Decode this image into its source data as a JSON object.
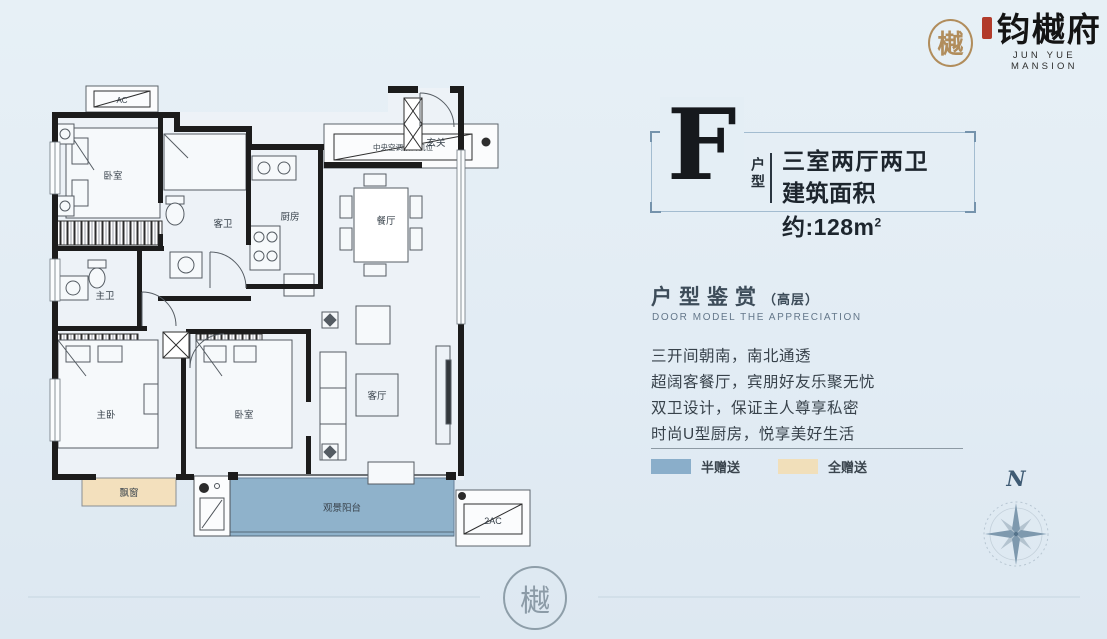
{
  "page": {
    "background": "#e4eef5"
  },
  "logo": {
    "seal_char": "樾",
    "brand_cn": "钧樾府",
    "brand_en": "JUN YUE MANSION"
  },
  "unit": {
    "letter": "F",
    "type_vertical": "户型",
    "spec": "三室两厅两卫",
    "area_prefix": "建筑面积约:",
    "area_value": "128m",
    "area_exponent": "2"
  },
  "section": {
    "title": "户型鉴赏",
    "title_note": "（高层）",
    "subtitle": "DOOR MODEL THE APPRECIATION"
  },
  "description": {
    "lines": [
      "三开间朝南，南北通透",
      "超阔客餐厅，宾朋好友乐聚无忧",
      "双卫设计，保证主人尊享私密",
      "时尚U型厨房，悦享美好生活"
    ]
  },
  "legend": {
    "half": {
      "label": "半赠送",
      "color": "#8aaeca"
    },
    "full": {
      "label": "全赠送",
      "color": "#f1dfba"
    }
  },
  "compass": {
    "north": "N"
  },
  "floorplan": {
    "rooms": {
      "bedroom_top": "卧室",
      "guest_bath": "客卫",
      "kitchen": "厨房",
      "dining": "餐厅",
      "entry": "玄关",
      "master_bath": "主卫",
      "master_bedroom": "主卧",
      "bedroom_second": "卧室",
      "living": "客厅",
      "bay_window": "飘窗",
      "balcony": "观景阳台"
    },
    "annotations": {
      "ac": "AC",
      "central_ac": "中央空调预留机位",
      "two_ac": "2AC"
    },
    "colors": {
      "half_gift": "#8fb2cb",
      "full_gift": "#f3e0bd",
      "wall": "#1c1c1c",
      "room_fill": "#edf2f7"
    }
  },
  "watermark": {
    "seal_char": "樾"
  }
}
